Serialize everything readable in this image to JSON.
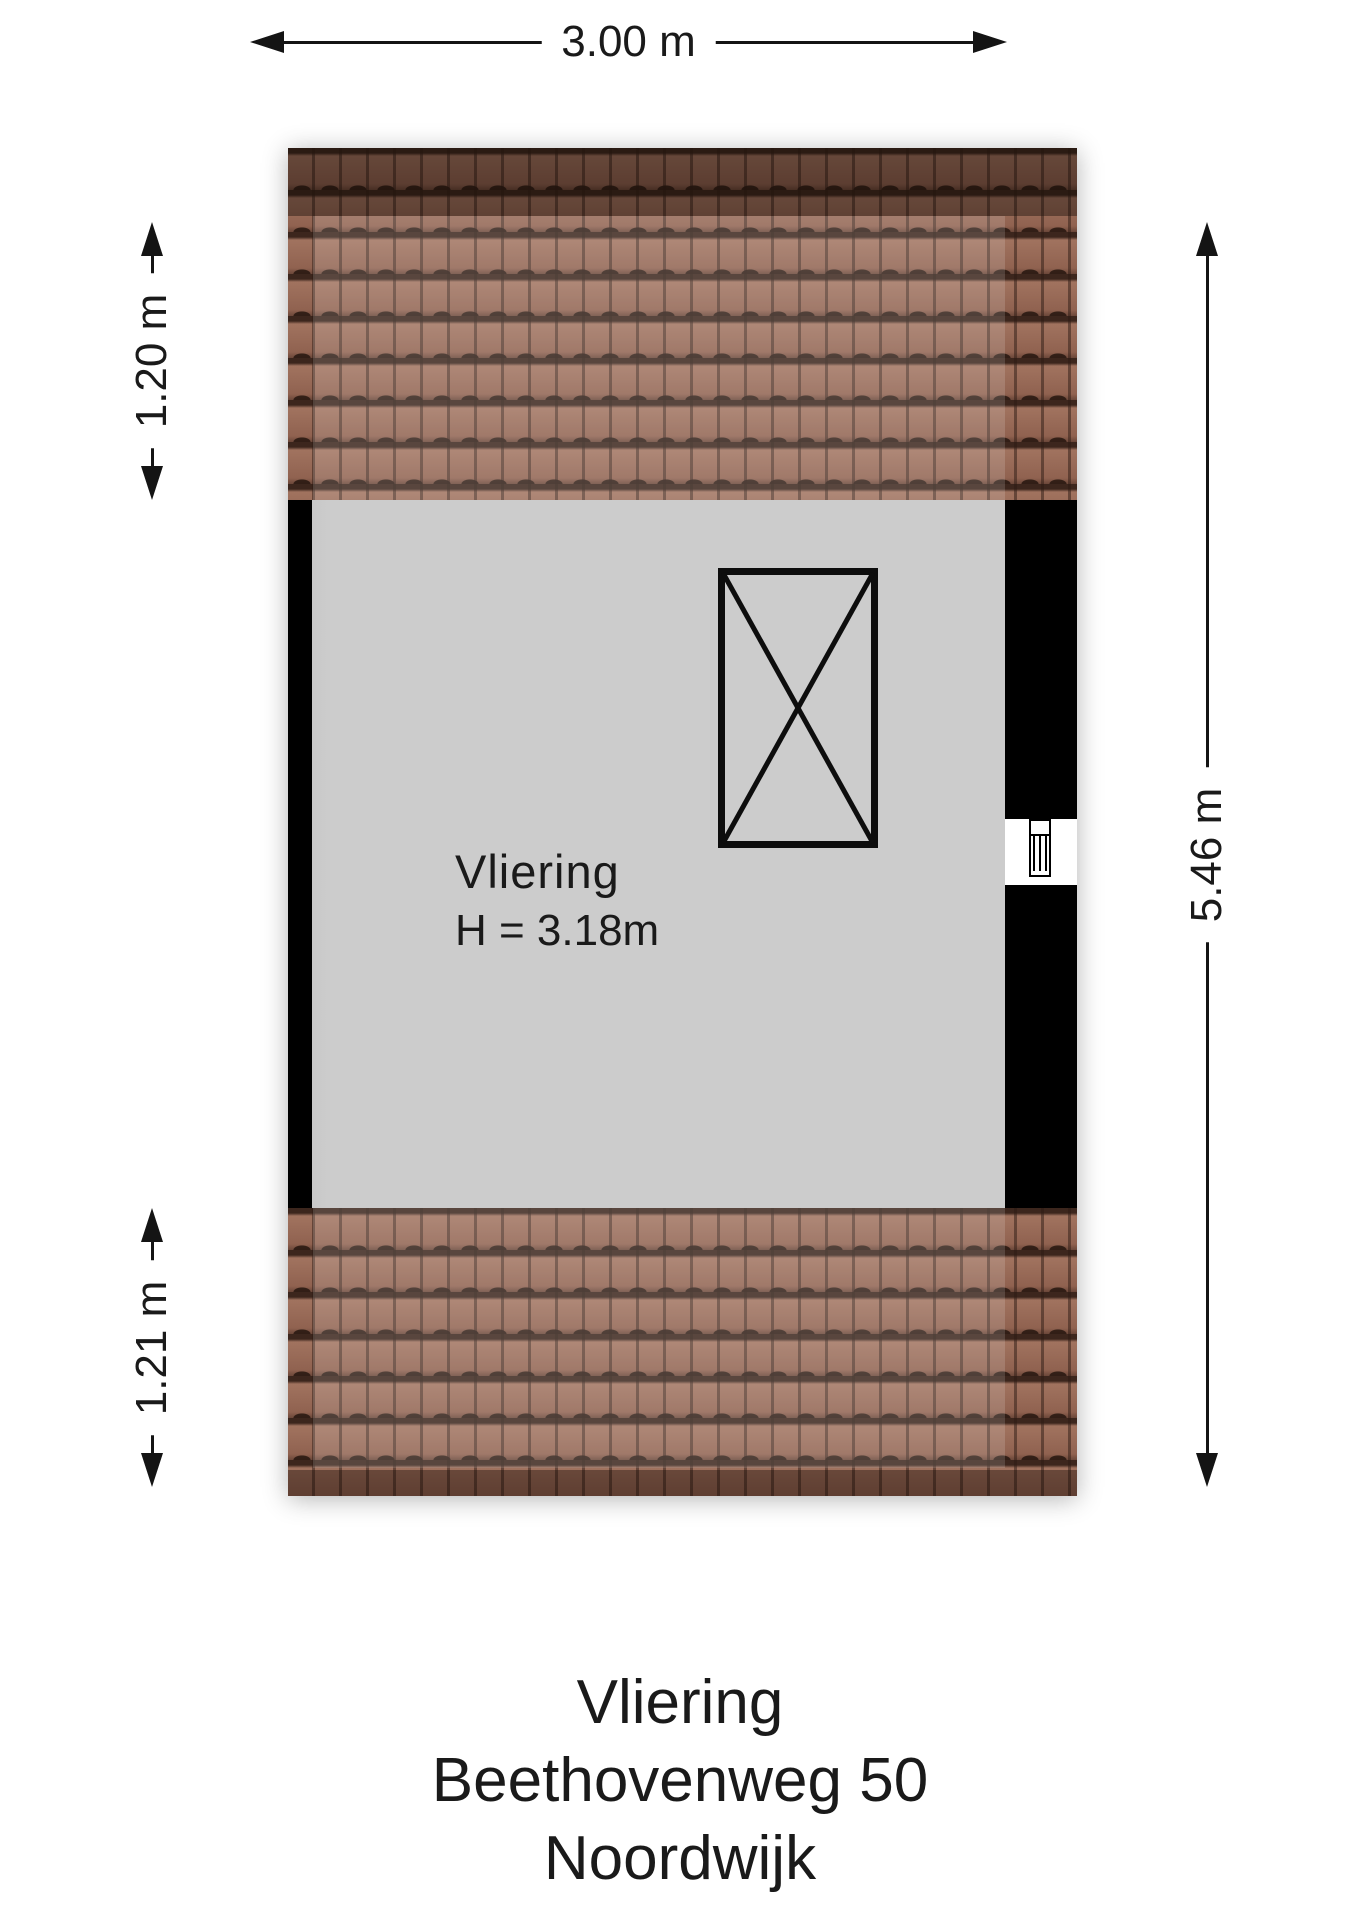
{
  "page": {
    "background": "#ffffff"
  },
  "colors": {
    "wall": "#000000",
    "floor": "#cbcbcb",
    "roof_tile_base": "#9a6d5c",
    "roof_tile_gap": "#3c261d",
    "dimension_line": "#141414"
  },
  "dimensions": {
    "width_top": {
      "label": "3.00 m"
    },
    "roof_left_top": {
      "label": "1.20 m"
    },
    "roof_left_bottom": {
      "label": "1.21 m"
    },
    "height_right": {
      "label": "5.46 m"
    }
  },
  "room": {
    "name": "Vliering",
    "ceiling_height": "H = 3.18m"
  },
  "caption": {
    "line1": "Vliering",
    "line2": "Beethovenweg 50",
    "line3": "Noordwijk"
  }
}
